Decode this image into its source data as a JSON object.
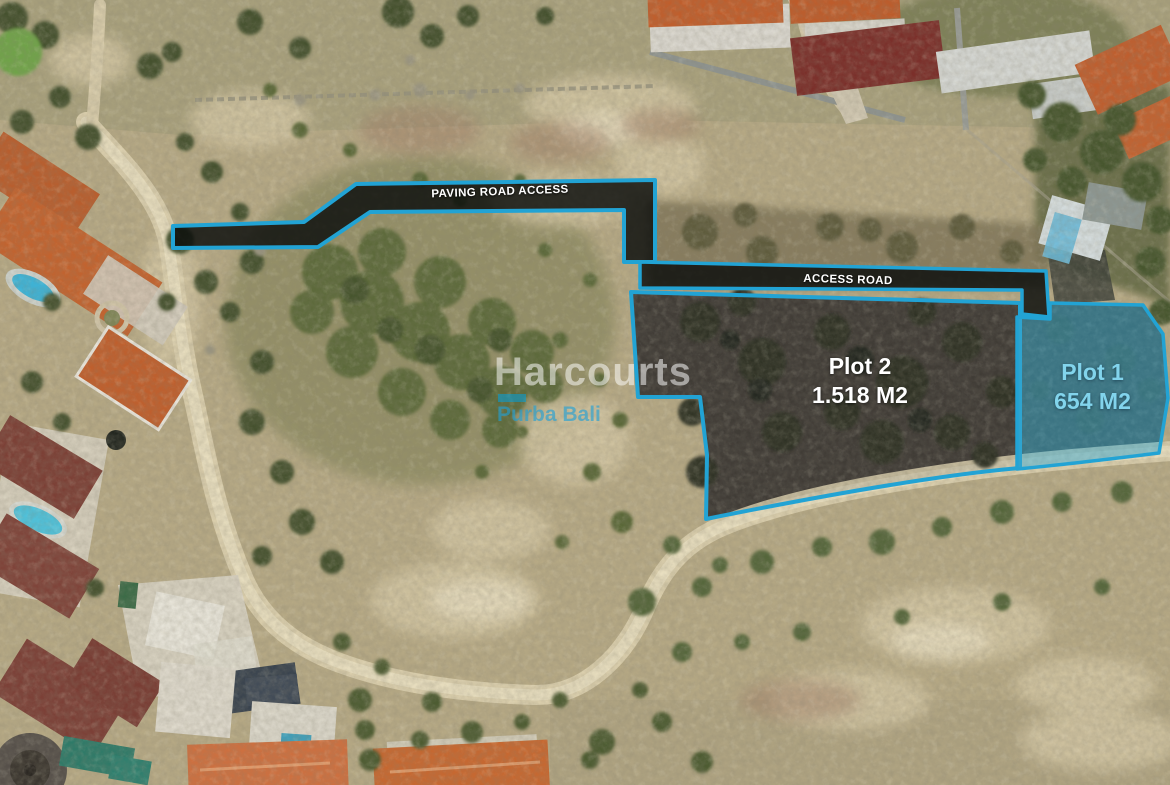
{
  "image": {
    "type": "aerial-drone-photo",
    "subject": "Land plots for sale with marked access roads, surrounded by villas, scrubland and dirt roads"
  },
  "annotations": {
    "paving_road_label": "PAVING ROAD ACCESS",
    "access_road_label": "ACCESS ROAD",
    "plots": [
      {
        "name": "Plot 1",
        "area": "654 M2",
        "style": "highlighted-cyan-fill"
      },
      {
        "name": "Plot 2",
        "area": "1.518 M2",
        "style": "cyan-outline"
      }
    ]
  },
  "watermark": {
    "brand": "Harcourts",
    "office": "Purba Bali"
  },
  "colors": {
    "outline_cyan": "#22a3d4",
    "road_band_fill": "rgba(10,12,11,0.82)",
    "plot1_fill": "rgba(58,166,204,0.5)",
    "plot1_text": "#82d4ec",
    "label_text": "#ffffff",
    "watermark_text": "rgba(255,255,255,0.52)",
    "watermark_cyan": "rgba(30,160,215,0.62)"
  }
}
